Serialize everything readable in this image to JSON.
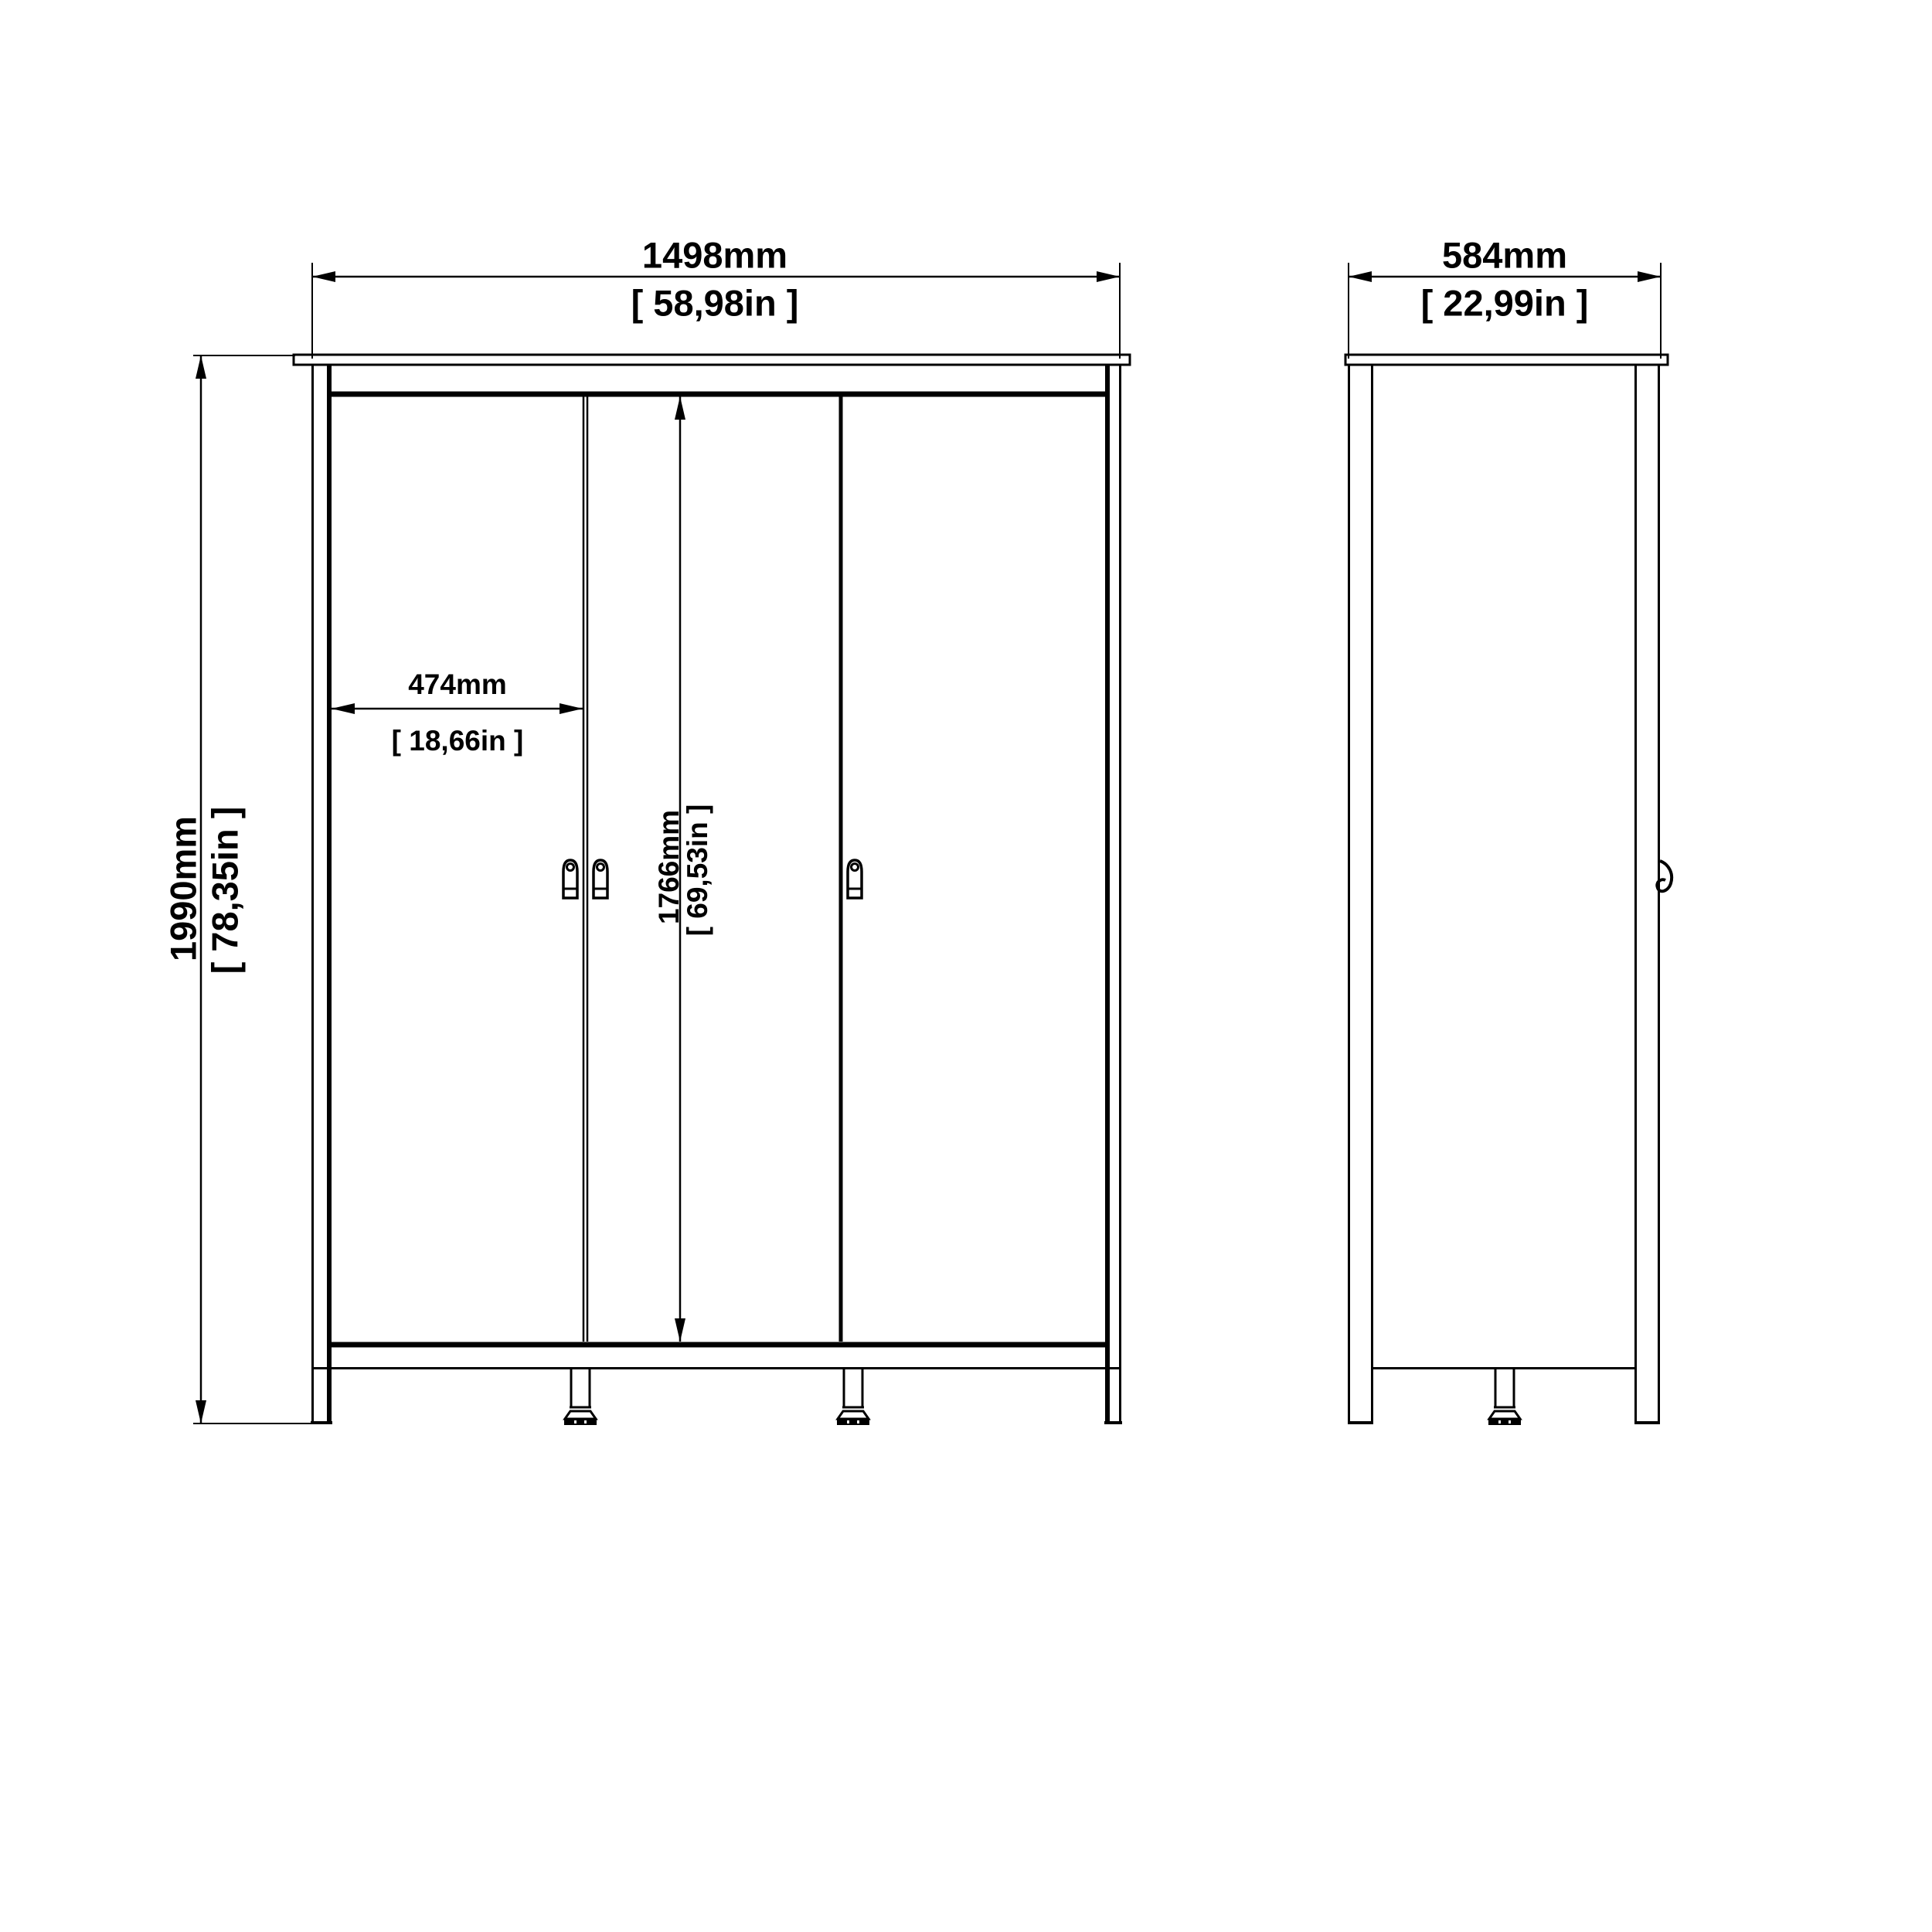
{
  "drawing": {
    "front_view": {
      "width": {
        "mm": "1498mm",
        "inches": "[ 58,98in ]"
      },
      "height": {
        "mm": "1990mm",
        "inches": "[ 78,35in ]"
      },
      "door_width": {
        "mm": "474mm",
        "inches": "[ 18,66in ]"
      },
      "door_height": {
        "mm": "1766mm",
        "inches": "[ 69,53in ]"
      }
    },
    "side_view": {
      "depth": {
        "mm": "584mm",
        "inches": "[ 22,99in ]"
      }
    },
    "colors": {
      "line": "#000000",
      "background": "#ffffff"
    }
  }
}
